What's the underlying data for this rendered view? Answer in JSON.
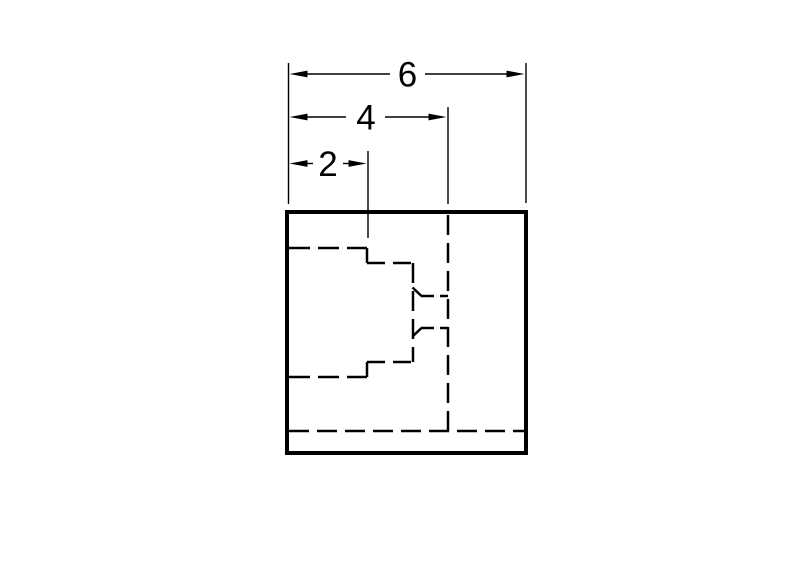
{
  "drawing": {
    "background_color": "#ffffff",
    "line_color": "#000000",
    "dimensions": [
      {
        "label": "6"
      },
      {
        "label": "4"
      },
      {
        "label": "2"
      }
    ]
  }
}
